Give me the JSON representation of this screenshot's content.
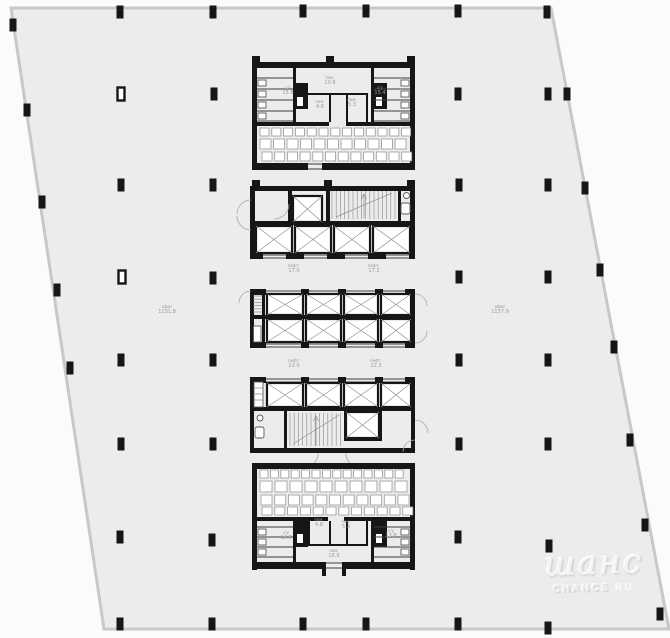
{
  "watermark": {
    "brand": "шанс",
    "site": "CHANCE",
    "tld": "RU"
  },
  "plan": {
    "colors": {
      "page": "#fbfbfb",
      "floor": "#ececec",
      "outline": "#c8c8c8",
      "wall": "#161616",
      "thin": "#3d3d3d",
      "light": "#8f8f8f",
      "fixture": "#5a5a5a",
      "label": "#9a9a9a",
      "watermark": "#ececec"
    },
    "outline_points": "11,8 551,8 669,629 104,629",
    "columns": [
      [
        120,
        12
      ],
      [
        213,
        12
      ],
      [
        303,
        11
      ],
      [
        366,
        11
      ],
      [
        458,
        11
      ],
      [
        547,
        12
      ],
      [
        13,
        25
      ],
      [
        27,
        110
      ],
      [
        42,
        202
      ],
      [
        57,
        290
      ],
      [
        70,
        368
      ],
      [
        121,
        94,
        1
      ],
      [
        121,
        185
      ],
      [
        122,
        277,
        1
      ],
      [
        121,
        360
      ],
      [
        121,
        444
      ],
      [
        120,
        537
      ],
      [
        120,
        624
      ],
      [
        214,
        94
      ],
      [
        213,
        185
      ],
      [
        213,
        278
      ],
      [
        213,
        360
      ],
      [
        213,
        444
      ],
      [
        212,
        540
      ],
      [
        212,
        624
      ],
      [
        303,
        624
      ],
      [
        366,
        624
      ],
      [
        458,
        94
      ],
      [
        459,
        185
      ],
      [
        459,
        277
      ],
      [
        459,
        360
      ],
      [
        459,
        444
      ],
      [
        458,
        537
      ],
      [
        458,
        624
      ],
      [
        548,
        94
      ],
      [
        548,
        185
      ],
      [
        548,
        277
      ],
      [
        548,
        360
      ],
      [
        548,
        444
      ],
      [
        549,
        546
      ],
      [
        548,
        628
      ],
      [
        567,
        94
      ],
      [
        585,
        188
      ],
      [
        600,
        270
      ],
      [
        614,
        347
      ],
      [
        630,
        440
      ],
      [
        645,
        525
      ],
      [
        660,
        614
      ]
    ],
    "shafts": [
      [
        293,
        196,
        29,
        26
      ],
      [
        256,
        226,
        36,
        27
      ],
      [
        295,
        226,
        36,
        27
      ],
      [
        334,
        226,
        36,
        27
      ],
      [
        373,
        226,
        37,
        27
      ],
      [
        267,
        294,
        36,
        21
      ],
      [
        306,
        294,
        35,
        21
      ],
      [
        344,
        294,
        34,
        21
      ],
      [
        381,
        294,
        30,
        21
      ],
      [
        267,
        319,
        36,
        23
      ],
      [
        306,
        319,
        35,
        23
      ],
      [
        344,
        319,
        34,
        23
      ],
      [
        381,
        319,
        30,
        23
      ],
      [
        267,
        383,
        36,
        24
      ],
      [
        306,
        383,
        35,
        24
      ],
      [
        344,
        383,
        34,
        24
      ],
      [
        381,
        383,
        30,
        24
      ],
      [
        346,
        412,
        33,
        26
      ]
    ],
    "stairs": [
      {
        "x0": 332,
        "x1": 396,
        "y0": 191,
        "y1": 219,
        "step": 4.2
      },
      {
        "x0": 290,
        "x1": 342,
        "y0": 413,
        "y1": 446,
        "step": 4.2
      }
    ],
    "furniture": [
      {
        "x0": 260,
        "y": 128,
        "w": 9,
        "h": 8,
        "step": 11.8,
        "count": 13
      },
      {
        "x0": 260,
        "y": 139,
        "w": 11,
        "h": 10,
        "step": 13.5,
        "count": 11
      },
      {
        "x0": 262,
        "y": 152,
        "w": 10,
        "h": 9,
        "step": 12.7,
        "count": 12
      },
      {
        "x0": 260,
        "y": 470,
        "w": 8,
        "h": 8,
        "step": 10.4,
        "count": 14
      },
      {
        "x0": 260,
        "y": 481,
        "w": 12,
        "h": 11,
        "step": 15.0,
        "count": 10
      },
      {
        "x0": 261,
        "y": 495,
        "w": 11,
        "h": 10,
        "step": 13.7,
        "count": 11
      },
      {
        "x0": 262,
        "y": 507,
        "w": 10,
        "h": 8,
        "step": 12.8,
        "count": 12
      }
    ],
    "labels": [
      {
        "x": 330,
        "y": 79,
        "kind": "пом.",
        "area": "10.8"
      },
      {
        "x": 288,
        "y": 89,
        "kind": "с/у",
        "area": "15.8"
      },
      {
        "x": 380,
        "y": 89,
        "kind": "с/у",
        "area": "15.4"
      },
      {
        "x": 320,
        "y": 103,
        "kind": "пом.",
        "area": "4.8"
      },
      {
        "x": 352,
        "y": 101,
        "kind": "пом.",
        "area": "5.3"
      },
      {
        "x": 294,
        "y": 267,
        "kind": "лифт.",
        "area": "17.0"
      },
      {
        "x": 374,
        "y": 267,
        "kind": "лифт.",
        "area": "17.2"
      },
      {
        "x": 167,
        "y": 308,
        "kind": "офис",
        "area": "1131.8"
      },
      {
        "x": 500,
        "y": 308,
        "kind": "офис",
        "area": "1137.9"
      },
      {
        "x": 294,
        "y": 362,
        "kind": "лифт.",
        "area": "22.0"
      },
      {
        "x": 376,
        "y": 362,
        "kind": "лифт.",
        "area": "22.3"
      },
      {
        "x": 319,
        "y": 521,
        "kind": "пом.",
        "area": "4.8"
      },
      {
        "x": 346,
        "y": 523,
        "kind": "пом.",
        "area": "5.3"
      },
      {
        "x": 286,
        "y": 534,
        "kind": "с/у",
        "area": "13.8"
      },
      {
        "x": 391,
        "y": 532,
        "kind": "с/у",
        "area": "13.8"
      },
      {
        "x": 334,
        "y": 552,
        "kind": "пом.",
        "area": "16.9"
      }
    ]
  }
}
